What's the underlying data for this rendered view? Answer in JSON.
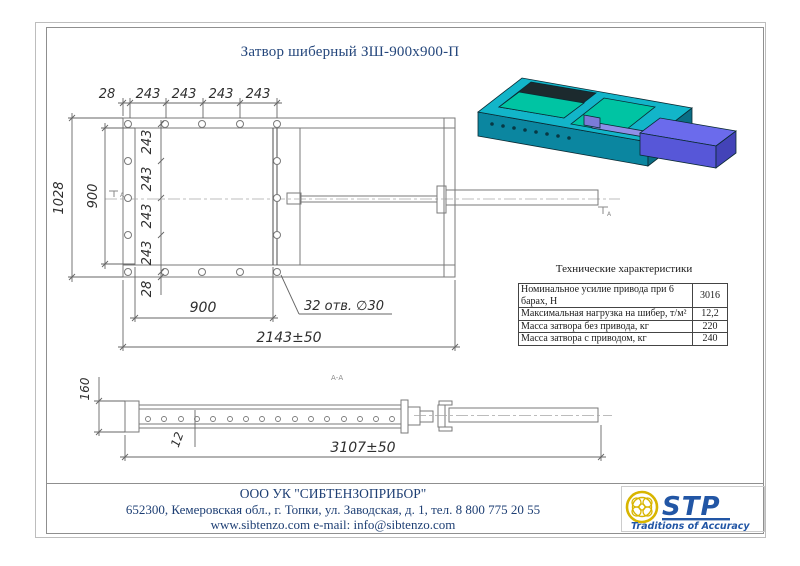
{
  "title": "Затвор шиберный ЗШ-900х900-П",
  "front_view": {
    "dims_top": [
      "28",
      "243",
      "243",
      "243",
      "243"
    ],
    "dim_height_outer": "1028",
    "dim_height_inner": "900",
    "dims_left_chain": [
      "243",
      "243",
      "243",
      "243",
      "28"
    ],
    "dim_width_inner": "900",
    "holes_label": "32 отв. ∅30",
    "dim_width_total": "2143±50",
    "section_marker": "А"
  },
  "side_view": {
    "section_label": "А-А",
    "dim_height": "160",
    "dim_thickness": "12",
    "dim_length": "3107±50"
  },
  "specs": {
    "title": "Технические характеристики",
    "rows": [
      {
        "label": "Номинальное усилие привода при 6 барах, Н",
        "value": "3016"
      },
      {
        "label": "Максимальная нагрузка на шибер, т/м²",
        "value": "12,2"
      },
      {
        "label": "Масса затвора без привода, кг",
        "value": "220"
      },
      {
        "label": "Масса затвора с приводом, кг",
        "value": "240"
      }
    ]
  },
  "footer": {
    "company": "ООО УК \"СИБТЕНЗОПРИБОР\"",
    "address": "652300, Кемеровская обл., г. Топки, ул. Заводская, д. 1, тел. 8 800 775 20 55",
    "web": "www.sibtenzo.com e-mail: info@sibtenzo.com"
  },
  "logo": {
    "text": "STP",
    "tagline": "Traditions of Accuracy"
  },
  "colors": {
    "title_text": "#25477c",
    "footer_text": "#1e3f74",
    "logo_blue": "#2256a5",
    "logo_yellow": "#d8b500",
    "render_teal": "#12b5c9",
    "render_teal_dark": "#0b86a0",
    "render_green": "#00c4a3",
    "render_blue": "#5757d8",
    "drawing_line": "#7a7a7a"
  }
}
